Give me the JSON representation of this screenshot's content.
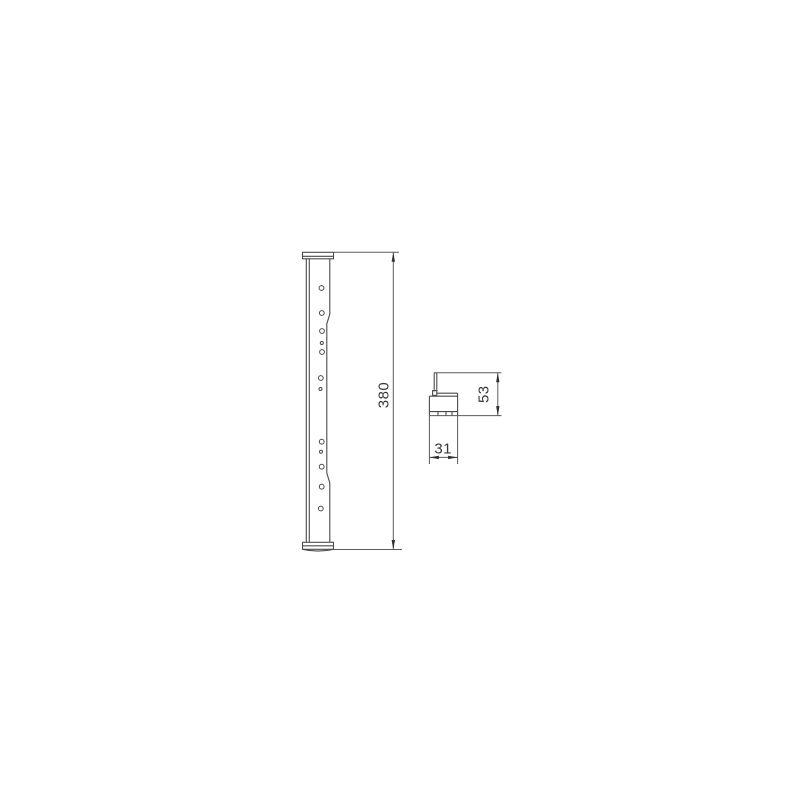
{
  "drawing": {
    "background_color": "#ffffff",
    "line_color": "#4a4a4a",
    "text_color": "#383838",
    "views": {
      "side_view": {
        "dimension_length": "380"
      },
      "section_view": {
        "dimension_height": "53",
        "dimension_width": "31"
      }
    }
  }
}
